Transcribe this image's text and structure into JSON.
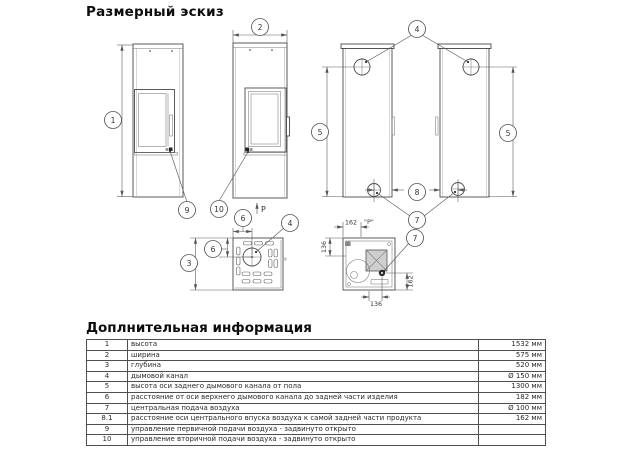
{
  "title": "Размерный эскиз",
  "info": {
    "heading": "Доплнительная информация",
    "rows": [
      {
        "num": "1",
        "label": "высота",
        "value": "1532 мм"
      },
      {
        "num": "2",
        "label": "ширина",
        "value": "575 мм"
      },
      {
        "num": "3",
        "label": "глубина",
        "value": "520 мм"
      },
      {
        "num": "4",
        "label": "дымовой канал",
        "value": "Ø 150 мм"
      },
      {
        "num": "5",
        "label": "высота оси заднего дымового канала от пола",
        "value": "1300 мм"
      },
      {
        "num": "6",
        "label": "расстояние от оси верхнего дымового канала до задней части изделия",
        "value": "182 мм"
      },
      {
        "num": "7",
        "label": "центральная подача воздуха",
        "value": "Ø 100 мм"
      },
      {
        "num": "8.1",
        "label": "расстояние оси центрального впуска воздуха к самой задней части продукта",
        "value": "162 мм"
      },
      {
        "num": "9",
        "label": "управление первичной подачи воздуха - задвинуто открыто",
        "value": ""
      },
      {
        "num": "10",
        "label": "управление вторичной подачи воздуха - задвинуто открыто",
        "value": ""
      }
    ]
  },
  "callouts": {
    "height": "1",
    "width": "2",
    "depth": "3",
    "flue": "4",
    "flue_axis_height": "5",
    "flue_axis_offset": "6",
    "air_inlet": "7",
    "air_axis_offset": "8",
    "primary_air_control": "9",
    "secondary_air_control": "10"
  },
  "dims": {
    "d162": "162",
    "d136": "136",
    "p_view": "\"P\"",
    "p_arrow": "P"
  },
  "colors": {
    "line": "#4a4a4a",
    "dim": "#5a5a5a",
    "text": "#2a2a2a",
    "table_border": "#4f4f4f"
  }
}
